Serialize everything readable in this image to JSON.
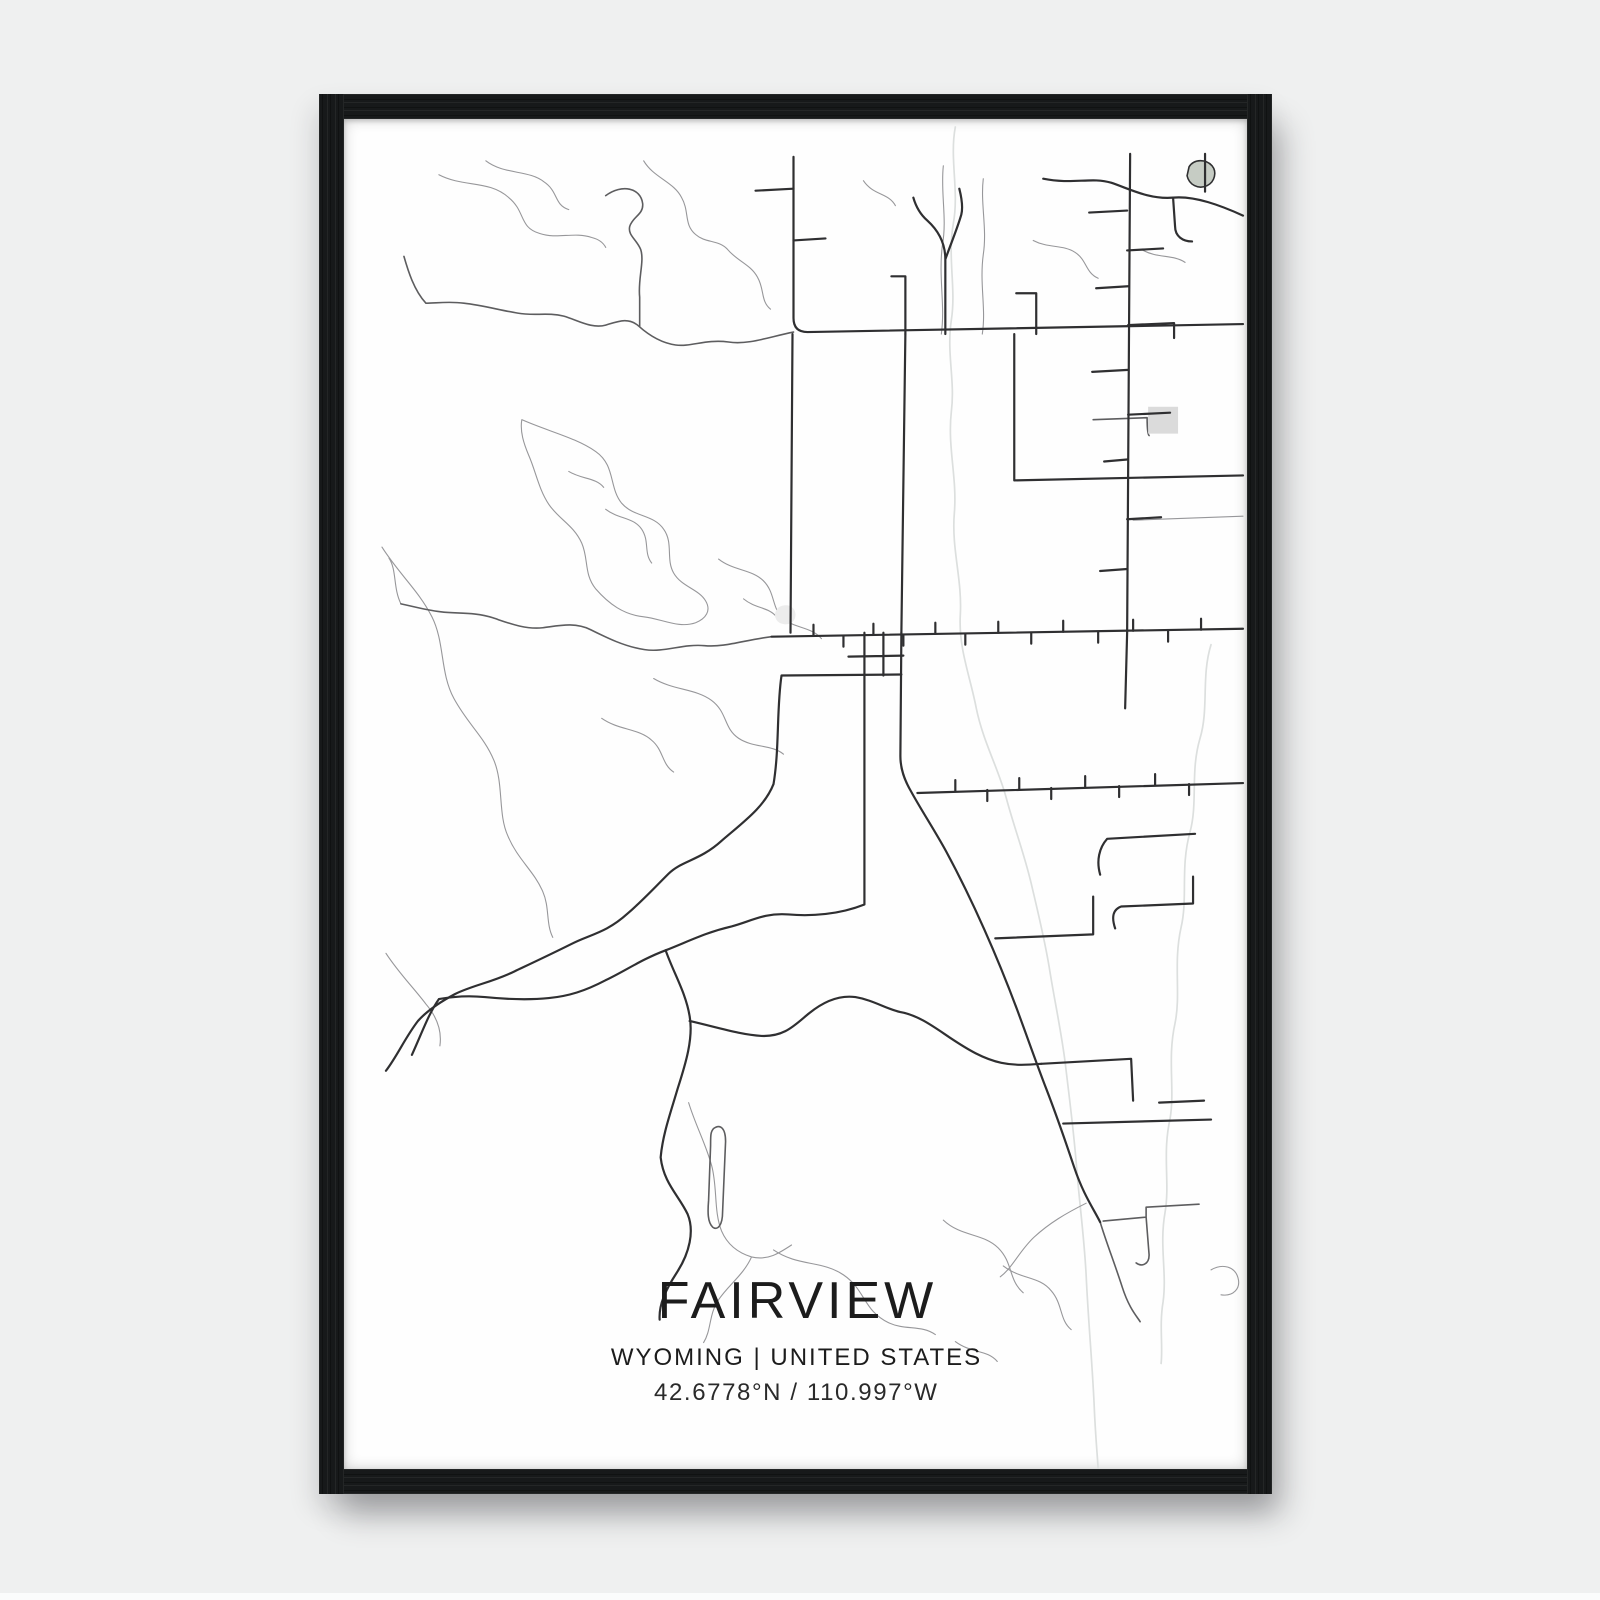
{
  "poster": {
    "title": "FAIRVIEW",
    "subtitle": "WYOMING | UNITED STATES",
    "coordinates": "42.6778°N / 110.997°W"
  },
  "colors": {
    "background": "#eff0f0",
    "frame": "#17191a",
    "paper": "#fefefe",
    "road_major": "#2f2f31",
    "road_medium": "#5d5d5f",
    "road_minor": "#97979a",
    "water": "#dcdfde",
    "pond_fill": "#c6ccc4",
    "area_fill": "#dbdbdb",
    "area_faint": "#ececec",
    "text": "#1c1c1c"
  },
  "map": {
    "viewbox": "0 0 904 1356",
    "roads_major": [
      "M450,38 L450,200 Q450,214 464,214 L900,206",
      "M449,216 L447,516",
      "M562,216 L558,516",
      "M558,516 L557,640 C557,653 561,664 568,676 C579,696 591,714 603,736 C617,762 629,787 641,814 C653,841 664,868 674,895 C684,922 693,948 703,974 C713,1000 722,1026 731,1053 C740,1080 750,1094 757,1108",
      "M787,35 L784,516 L782,592",
      "M428,520 L900,512",
      "M558,558 L438,559 C433,592 436,632 430,668 C421,691 400,706 378,725 C356,745 338,745 325,758 C308,775 299,785 284,798 C262,818 246,819 227,829 C205,840 190,847 171,856 C149,867 129,870 111,879 C96,887 82,897 74,906 C61,923 54,940 42,956",
      "M521,516 L521,789 C496,799 468,801 445,799 C421,797 407,806 388,811 C362,817 345,826 322,835 C298,844 281,856 262,865 C241,876 225,881 205,883 C185,885 161,884 141,882 C121,880 106,882 95,884 C85,898 78,918 68,940",
      "M322,835 C330,858 342,877 346,901 C350,923 342,949 334,974 C327,998 319,1020 317,1043 C320,1069 335,1081 344,1100 C351,1117 346,1139 333,1159 C322,1176 315,1191 316,1206",
      "M346,906 C376,913 398,920 418,921 C442,922 452,909 466,898 C482,885 497,880 512,882 C530,885 543,894 557,897 C575,900 592,913 607,923 C625,935 640,944 658,948 C672,951 685,950 698,949",
      "M698,949 L788,944 L790,986",
      "M574,677 L900,667",
      "M652,823 L750,819 L750,781",
      "M757,759 C753,745 756,732 764,723 L852,718",
      "M772,813 C768,801 770,794 778,791 L850,788 L850,761",
      "M700,60 C730,66 748,58 768,64 C786,70 806,81 830,79 C852,77 878,87 900,97",
      "M862,35 L862,73",
      "M671,216 L671,363 M671,363 L900,358",
      "M540,516 L540,559 M505,540 L560,539",
      "M602,216 L602,141 C602,125 595,112 584,102 C576,95 572,86 570,79 M602,141 C608,124 614,110 618,96 C620,88 618,78 616,70 M562,216 L562,158 L548,158 M693,216 L693,175 L673,175",
      "M784,92 L746,94 M784,132 L820,130 M785,168 L753,170 M785,207 L831,205 L831,220 M785,252 L749,254 M785,297 L827,295 M784,342 L761,344 M784,402 L818,400 M784,452 L757,454",
      "M470,519 L470,508 M500,519 L500,530 M530,518 L530,507 M560,518 L560,529 M592,517 L592,506 M622,517 L622,528 M655,516 L655,505 M688,516 L688,527 M720,515 L720,504 M755,515 L755,526 M790,514 L790,503 M825,514 L825,525 M858,513 L858,502",
      "M612,675 L612,664 M644,674 L644,685 M676,673 L676,662 M708,672 L708,683 M742,671 L742,660 M776,670 L776,681 M812,669 L812,658 M846,668 L846,679",
      "M450,70 L412,72 M450,122 L482,120",
      "M720,1009 L868,1005 M816,988 L861,986",
      "M830,79 L832,108 C832,118 840,123 849,123"
    ],
    "roads_medium": [
      "M450,214 C425,219 405,227 385,224 C362,221 348,229 332,227 C318,225 305,217 295,208 C285,199 275,203 262,207 C248,211 234,202 220,198 C204,194 190,198 174,195 C156,192 138,187 120,185 C105,183 92,185 82,185 C70,172 64,152 60,138",
      "M262,77 C278,65 297,69 299,85 C300,96 289,98 286,108 C284,117 293,121 297,131 C301,143 294,161 296,179 L296,208",
      "M428,520 C402,523 381,531 361,529 C339,527 321,536 301,533 C281,530 263,521 247,513 C231,505 215,509 199,511 C181,513 164,506 149,501 C131,495 113,497 97,495 C81,493 67,489 57,487",
      "M370,1014 C377,1009 382,1014 382,1027 L379,1098 C379,1111 374,1117 369,1113 C364,1108 364,1098 365,1086 L367,1031 C367,1021 367,1017 370,1014",
      "M757,1108 C763,1128 772,1151 779,1173 C786,1195 794,1203 797,1208",
      "M760,1107 L803,1103 L803,1093 L856,1090 M803,1103 L806,1141 C806,1151 798,1153 793,1149",
      "M750,302 L804,300 M804,300 C804,310 805,318 806,318"
    ],
    "roads_minor": [
      "M142,42 C160,56 185,51 200,63 C215,73 210,86 225,91",
      "M95,56 C120,69 145,61 165,79 C182,93 175,109 196,115 C214,121 230,113 248,119 C256,121 260,125 262,129",
      "M300,42 C310,59 330,63 338,79 C346,93 340,106 352,116 C362,125 375,121 384,131 C394,143 407,146 414,159 C421,171 417,183 427,191",
      "M178,302 C205,314 232,320 252,334 C272,348 265,370 278,386 C290,400 310,397 320,412 C330,426 322,442 330,456 C338,470 355,472 362,484 C368,494 362,502 352,506 C335,512 318,502 300,500 C280,498 265,487 252,472 C240,457 245,442 238,426 C230,408 215,402 205,387 C195,372 192,354 185,338 C180,326 176,314 178,302",
      "M262,392 C275,402 290,400 298,412 C306,424 300,436 308,446",
      "M225,354 C238,362 252,360 260,370",
      "M38,430 C55,457 75,474 88,500 C101,526 96,556 110,582 C124,608 140,620 150,644 C160,668 154,698 164,720 C174,744 190,755 199,776 C206,792 202,808 209,822",
      "M375,442 C390,454 408,452 420,464 C432,476 428,492 440,502 C452,512 468,510 478,522",
      "M400,482 C412,492 425,490 433,500",
      "M310,562 C330,574 352,572 368,584 C384,596 380,612 395,622 C410,632 428,628 440,638",
      "M258,602 C275,614 295,612 308,624 C320,634 318,648 330,656",
      "M42,838 C55,858 70,873 82,889 C94,903 98,917 96,931",
      "M345,988 C352,1011 362,1029 368,1051 C374,1073 370,1097 378,1117 C384,1131 395,1139 408,1143 C424,1147 436,1139 448,1131 M408,1143 C400,1161 385,1171 375,1186 C365,1201 368,1216 360,1229",
      "M430,1136 C455,1153 478,1146 500,1161 C522,1176 520,1197 545,1209 C562,1217 578,1211 592,1221",
      "M600,1106 C618,1123 640,1119 655,1134 C670,1149 665,1166 680,1179",
      "M660,1152 C678,1166 696,1162 708,1177 C720,1191 716,1206 728,1216",
      "M612,1228 C628,1240 644,1236 654,1248",
      "M868,1156 C880,1149 892,1153 895,1164 C898,1175 890,1183 878,1181",
      "M743,1089 C723,1099 706,1109 691,1123 C676,1137 670,1153 657,1163",
      "M640,60 C637,85 644,110 640,136 C636,166 643,190 639,216 M600,47 C597,74 604,100 599,127 C595,160 602,186 598,216",
      "M520,62 C530,77 545,74 552,87",
      "M690,122 C705,130 720,126 732,134 C744,142 742,154 755,160 M800,132 C815,140 830,136 842,144",
      "M790,403 L900,399",
      "M57,487 C49,471 53,453 45,441"
    ],
    "water": [
      "M612,8 C606,40 616,72 610,105 C604,140 613,170 608,202 C603,236 612,262 608,294 C604,330 614,360 611,396 C608,432 619,462 617,498 C615,532 627,560 633,592 C640,626 655,652 663,682 C671,712 681,738 688,768 C695,798 701,822 706,852 C711,884 718,916 722,948 C726,982 730,1012 733,1048 C736,1088 741,1122 743,1162 C745,1206 749,1248 751,1292 C752,1318 754,1340 755,1356",
      "M868,528 C858,560 866,592 857,622 C847,656 855,686 847,716 C837,752 845,782 838,812 C830,848 838,878 832,908 C824,944 832,974 827,1004 C819,1040 827,1068 822,1098 C816,1132 824,1158 820,1188 C816,1212 820,1232 818,1250"
    ],
    "areas": [
      {
        "name": "pond",
        "d": "M846,48 C851,40 863,40 869,47 C874,53 872,63 864,67 C855,71 846,66 844,57 Z",
        "fill": "pond_fill",
        "stroke": "road_major"
      },
      {
        "name": "field-block",
        "d": "M805,289 L835,289 L835,316 L805,316 Z",
        "fill": "area_fill"
      },
      {
        "name": "clearing",
        "d": "M436,490 C444,486 452,490 452,498 C452,506 444,510 436,506 C430,502 430,494 436,490 Z",
        "fill": "area_faint"
      }
    ]
  }
}
